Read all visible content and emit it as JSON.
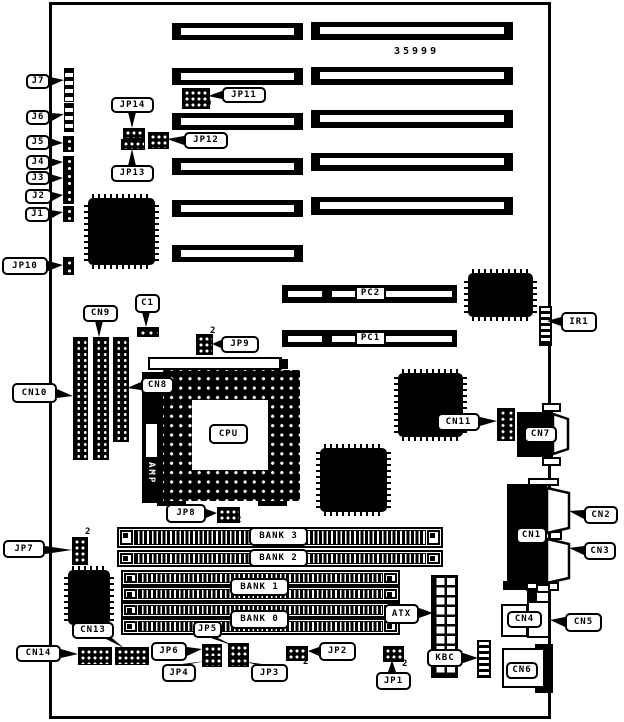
{
  "board_number": "35999",
  "labels": {
    "j7": "J7",
    "j6": "J6",
    "j5": "J5",
    "j4": "J4",
    "j3": "J3",
    "j2": "J2",
    "j1": "J1",
    "jp10": "JP10",
    "jp14": "JP14",
    "jp13": "JP13",
    "jp12": "JP12",
    "jp11": "JP11",
    "jp9": "JP9",
    "jp8": "JP8",
    "jp7": "JP7",
    "jp6": "JP6",
    "jp5": "JP5",
    "jp4": "JP4",
    "jp3": "JP3",
    "jp2": "JP2",
    "jp1": "JP1",
    "c1": "C1",
    "cn9": "CN9",
    "cn10": "CN10",
    "cn8": "CN8",
    "cn11": "CN11",
    "cn7": "CN7",
    "cn1": "CN1",
    "cn2": "CN2",
    "cn3": "CN3",
    "cn4": "CN4",
    "cn5": "CN5",
    "cn6": "CN6",
    "cn13": "CN13",
    "cn14": "CN14",
    "ir1": "IR1",
    "atx": "ATX",
    "kbc": "KBC",
    "pc2": "PC2",
    "pc1": "PC1",
    "bank3": "BANK 3",
    "bank2": "BANK 2",
    "bank1": "BANK 1",
    "bank0": "BANK 0",
    "cpu": "CPU",
    "amp": "AMP"
  },
  "markers": {
    "jp11": "9",
    "jp9": "2",
    "jp8": "2",
    "jp7": "2",
    "jp2": "2",
    "jp1": "2"
  }
}
